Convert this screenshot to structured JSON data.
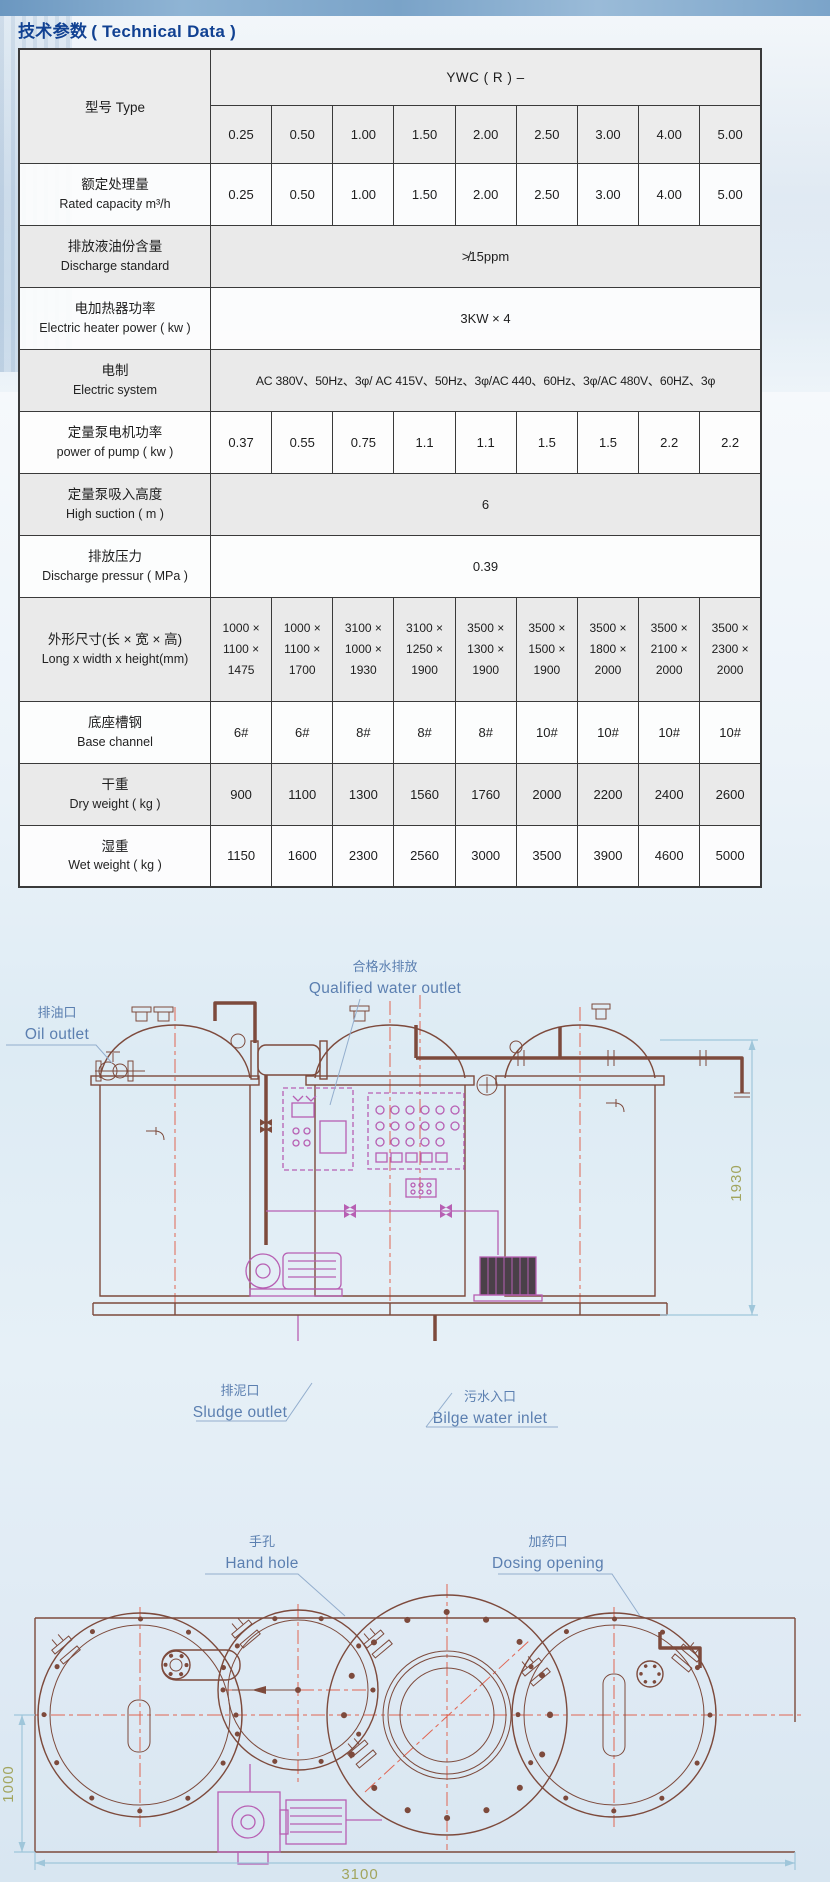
{
  "title": {
    "zh": "技术参数",
    "en": "( Technical Data )"
  },
  "table": {
    "type_label": "型号 Type",
    "series": "YWC ( R ) –",
    "size_headers": [
      "0.25",
      "0.50",
      "1.00",
      "1.50",
      "2.00",
      "2.50",
      "3.00",
      "4.00",
      "5.00"
    ],
    "rows": [
      {
        "label_zh": "额定处理量",
        "label_en": "Rated capacity  m³/h",
        "values": [
          "0.25",
          "0.50",
          "1.00",
          "1.50",
          "2.00",
          "2.50",
          "3.00",
          "4.00",
          "5.00"
        ]
      },
      {
        "label_zh": "排放液油份含量",
        "label_en": "Discharge standard",
        "span_value": "≯15ppm"
      },
      {
        "label_zh": "电加热器功率",
        "label_en": "Electric heater power ( kw )",
        "span_value": "3KW × 4"
      },
      {
        "label_zh": "电制",
        "label_en": "Electric system",
        "span_value": "AC 380V、50Hz、3φ/ AC 415V、50Hz、3φ/AC 440、60Hz、3φ/AC 480V、60HZ、3φ"
      },
      {
        "label_zh": "定量泵电机功率",
        "label_en": "power of pump ( kw )",
        "values": [
          "0.37",
          "0.55",
          "0.75",
          "1.1",
          "1.1",
          "1.5",
          "1.5",
          "2.2",
          "2.2"
        ]
      },
      {
        "label_zh": "定量泵吸入高度",
        "label_en": "High suction  ( m )",
        "span_value": "6"
      },
      {
        "label_zh": "排放压力",
        "label_en": "Discharge pressur ( MPa )",
        "span_value": "0.39"
      },
      {
        "label_zh": "外形尺寸(长 × 宽 × 高)",
        "label_en": "Long x width x height(mm)",
        "values": [
          "1000 ×\n1100 ×\n1475",
          "1000 ×\n1100 ×\n1700",
          "3100 ×\n1000 ×\n1930",
          "3100 ×\n1250 ×\n1900",
          "3500 ×\n1300 ×\n1900",
          "3500 ×\n1500 ×\n1900",
          "3500 ×\n1800 ×\n2000",
          "3500 ×\n2100 ×\n2000",
          "3500 ×\n2300 ×\n2000"
        ]
      },
      {
        "label_zh": "底座槽钢",
        "label_en": "Base channel",
        "values": [
          "6#",
          "6#",
          "8#",
          "8#",
          "8#",
          "10#",
          "10#",
          "10#",
          "10#"
        ]
      },
      {
        "label_zh": "干重",
        "label_en": "Dry weight  ( kg )",
        "values": [
          "900",
          "1100",
          "1300",
          "1560",
          "1760",
          "2000",
          "2200",
          "2400",
          "2600"
        ]
      },
      {
        "label_zh": "湿重",
        "label_en": "Wet weight  ( kg )",
        "values": [
          "1150",
          "1600",
          "2300",
          "2560",
          "3000",
          "3500",
          "3900",
          "4600",
          "5000"
        ]
      }
    ]
  },
  "front_view": {
    "oil_outlet_zh": "排油口",
    "oil_outlet_en": "Oil outlet",
    "qualified_outlet_zh": "合格水排放",
    "qualified_outlet_en": "Qualified water outlet",
    "sludge_outlet_zh": "排泥口",
    "sludge_outlet_en": "Sludge outlet",
    "bilge_inlet_zh": "污水入口",
    "bilge_inlet_en": "Bilge water inlet",
    "height_dim": "1930"
  },
  "plan_view": {
    "hand_hole_zh": "手孔",
    "hand_hole_en": "Hand hole",
    "dosing_zh": "加药口",
    "dosing_en": "Dosing opening",
    "length_dim": "3100",
    "width_dim": "1000"
  },
  "colors": {
    "title_blue": "#114192",
    "drawing_label_blue": "#5b7fb0",
    "drawing_line": "#7d4a3c",
    "magenta": "#b75fb3",
    "centerline_red": "#e06552",
    "dim_olive": "#a2a55e",
    "header_gray": "#ececec"
  }
}
